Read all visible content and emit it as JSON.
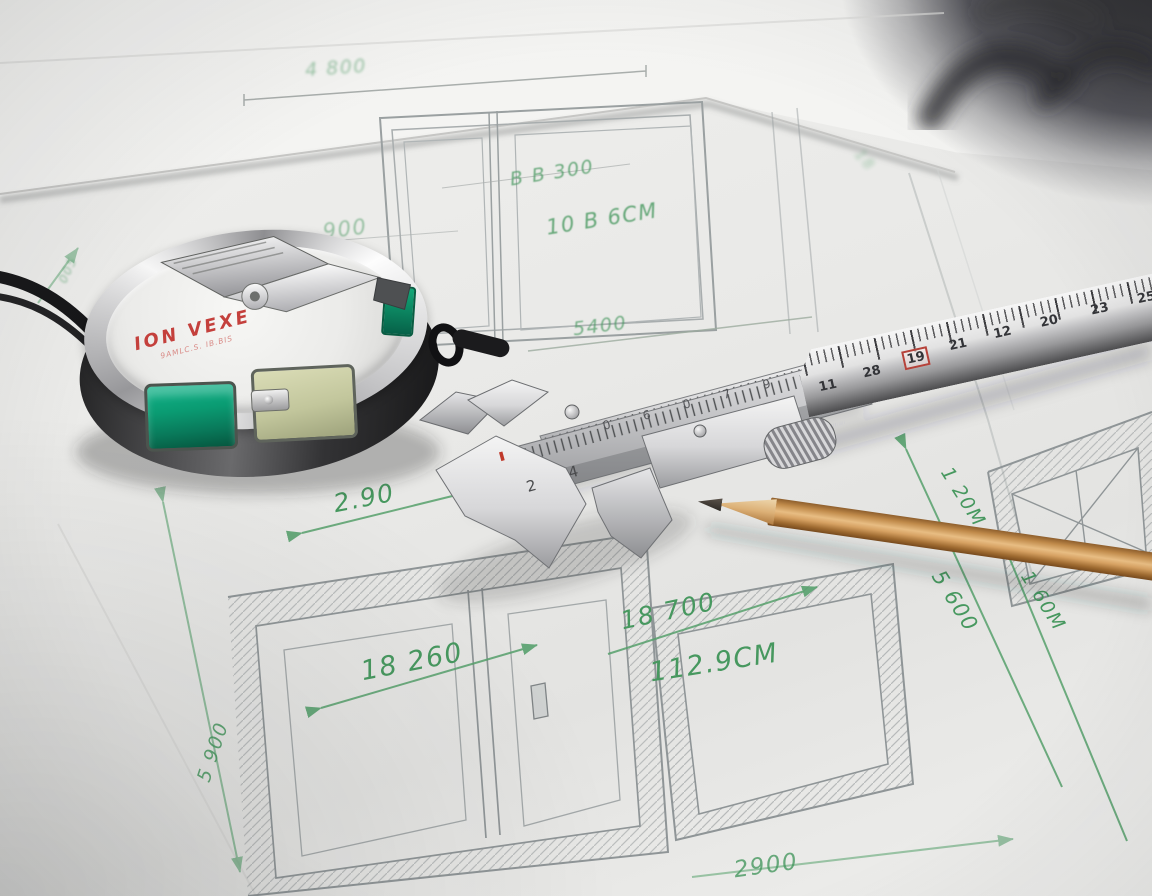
{
  "annotations": [
    {
      "id": "dim-top",
      "text": "4 800"
    },
    {
      "id": "dim-topleft",
      "text": "005"
    },
    {
      "id": "dim-900",
      "text": "900"
    },
    {
      "id": "dim-bb300",
      "text": "B B 300"
    },
    {
      "id": "dim-10b6cm",
      "text": "10 B 6CM"
    },
    {
      "id": "dim-5400",
      "text": "5400"
    },
    {
      "id": "dim-290",
      "text": "2.90"
    },
    {
      "id": "dim-18260",
      "text": "18 260"
    },
    {
      "id": "dim-18700",
      "text": "18 700"
    },
    {
      "id": "dim-1129cm",
      "text": "112.9CM"
    },
    {
      "id": "dim-120m",
      "text": "1 20M"
    },
    {
      "id": "dim-5600",
      "text": "5 600"
    },
    {
      "id": "dim-160m",
      "text": "1 60M"
    },
    {
      "id": "dim-2900",
      "text": "2900"
    },
    {
      "id": "dim-5900",
      "text": "5 900"
    },
    {
      "id": "dim-smudge",
      "text": "18"
    }
  ],
  "tape_measure": {
    "brand": "ION VEXE",
    "sub_brand": "9AMLC.S. IB.BIS"
  },
  "ruler": {
    "numbers": [
      "11",
      "28",
      "19",
      "21",
      "12",
      "20",
      "23",
      "25",
      "15"
    ],
    "red_boxed_index": 2
  },
  "caliper": {
    "beam_numbers": [
      "2",
      "4"
    ],
    "rail_numbers": [
      "0",
      "6",
      "0",
      "7",
      "9",
      "0"
    ]
  },
  "colors": {
    "ink_green": "#47985f",
    "brand_red": "#c4403c",
    "tape_green": "#0aa57c",
    "pencil_wood": "#c99257",
    "paper": "#ececea",
    "metal": "#c9c9cb"
  }
}
